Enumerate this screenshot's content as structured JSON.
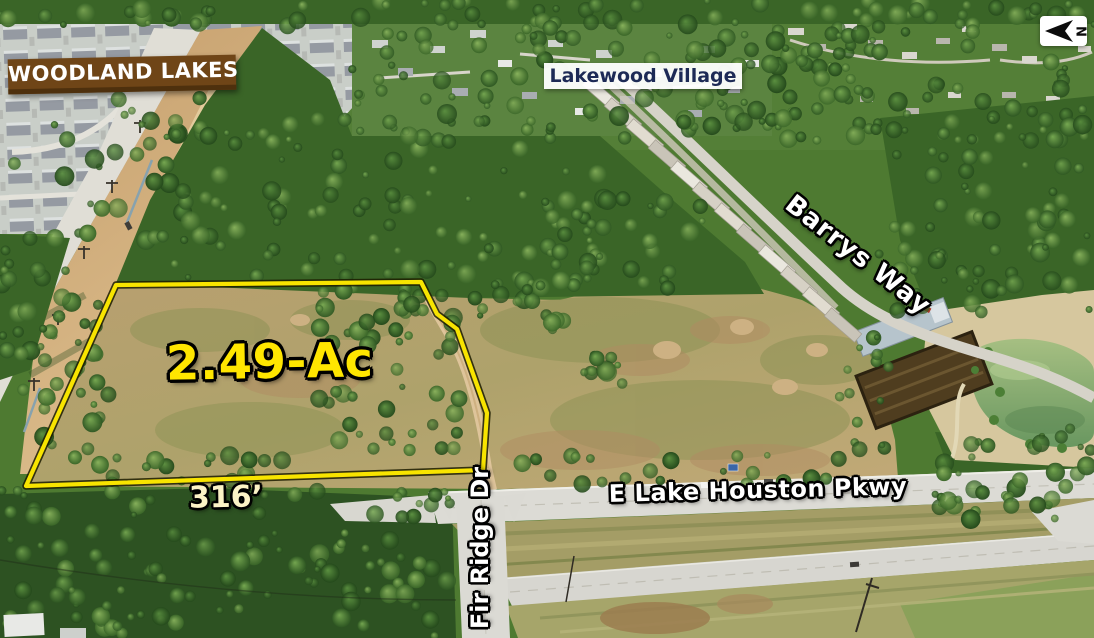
{
  "labels": {
    "subdivision_sign": {
      "text": "WOODLAND LAKES",
      "bg_color": "#6f4517",
      "text_color": "#ffffff"
    },
    "neighborhood": {
      "text": "Lakewood Village",
      "bg_color": "#ffffff",
      "text_color": "#1d2a56"
    },
    "street_barrys_way": {
      "text": "Barrys Way",
      "text_color": "#ffffff"
    },
    "acreage": {
      "text": "2.49-Ac",
      "text_color": "#ffe600"
    },
    "frontage": {
      "text": "316’",
      "text_color": "#fcf3c6"
    },
    "street_fir_ridge": {
      "text": "Fir Ridge Dr",
      "text_color": "#ffffff"
    },
    "street_parkway": {
      "text": "E Lake Houston Pkwy",
      "text_color": "#ffffff"
    },
    "north_arrow": {
      "letter": "N"
    }
  },
  "parcel": {
    "outline_color": "#f8e400"
  }
}
